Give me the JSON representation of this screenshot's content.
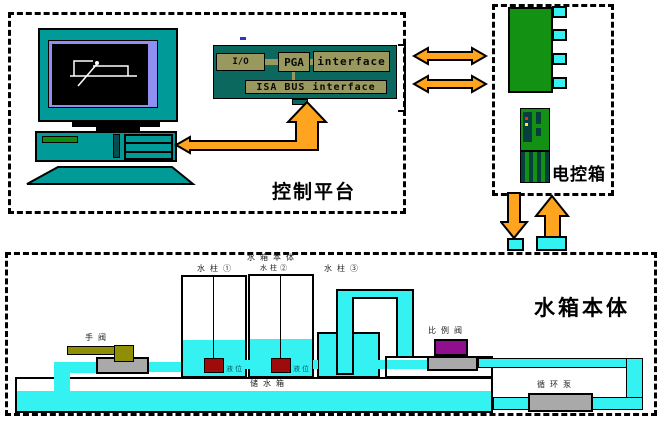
{
  "control_platform": {
    "label": "控制平台",
    "card": {
      "io": "I/O",
      "pga": "PGA",
      "interface": "interface",
      "isa_bus": "ISA BUS interface"
    }
  },
  "control_box": {
    "label": "电控箱"
  },
  "water_tank": {
    "label": "水箱本体",
    "assembly_label": "水箱本体",
    "tank1_label": "水柱①",
    "tank2_label": "水柱②",
    "tank3_label": "水柱③",
    "level_label": "液位",
    "hand_valve_label": "手阀",
    "proportional_valve_label": "比例阀",
    "reservoir_label": "储水箱",
    "pump_label": "循环泵"
  },
  "colors": {
    "teal": "#009a98",
    "card_green": "#0b685e",
    "khaki": "#99995f",
    "block_green": "#129112",
    "water_cyan": "#35f2f2",
    "arrow_orange": "#ffa41e",
    "bezel_violet": "#8f8ff2",
    "sensor_red": "#9e0b0b",
    "valve_purple": "#8f0f8f",
    "valve_olive": "#8f8f05",
    "pump_gray": "#a9a9a9"
  }
}
